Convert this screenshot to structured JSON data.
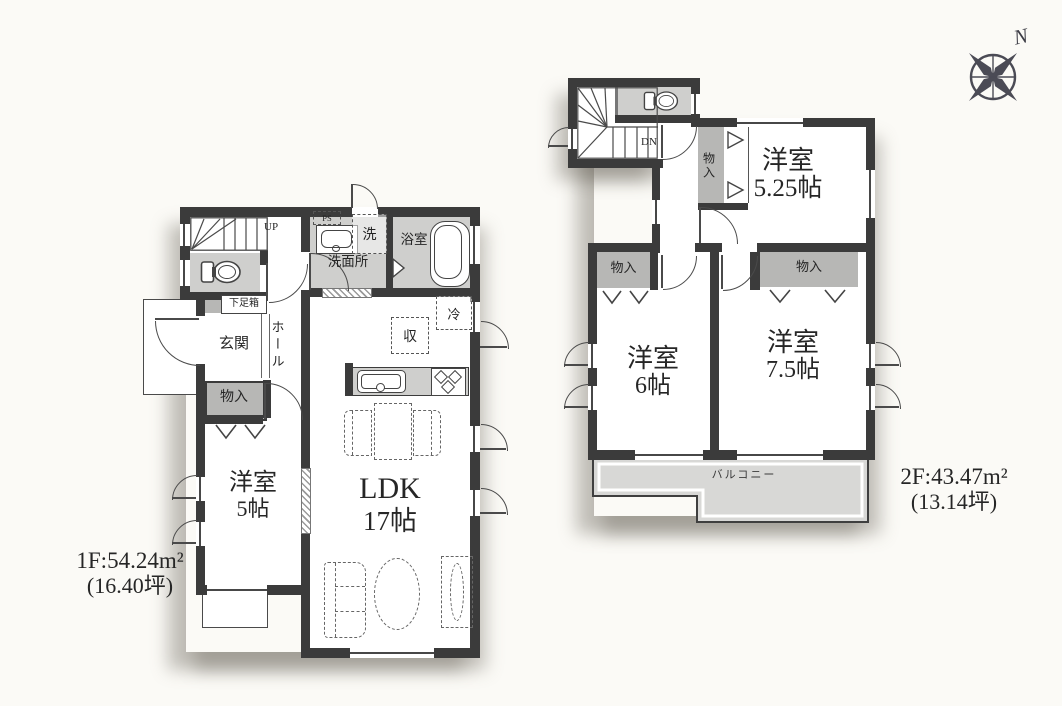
{
  "compass": {
    "north_label": "N"
  },
  "floor1": {
    "area_line1": "1F:54.24m²",
    "area_line2": "(16.40坪)",
    "stairs_label": "UP",
    "rooms": {
      "genkan": "玄関",
      "hall": "ホール",
      "shoebox": "下足箱",
      "storage": "物入",
      "bedroom_name": "洋室",
      "bedroom_size": "5帖",
      "ldk_name": "LDK",
      "ldk_size": "17帖",
      "washroom": "洗面所",
      "bathroom": "浴室",
      "washer": "洗",
      "ps": "PS",
      "fridge": "冷",
      "pantry": "収"
    }
  },
  "floor2": {
    "area_line1": "2F:43.47m²",
    "area_line2": "(13.14坪)",
    "stairs_label": "DN",
    "rooms": {
      "closet_a": "物入",
      "bedroom_a_name": "洋室",
      "bedroom_a_size": "5.25帖",
      "closet_b": "物入",
      "closet_c": "物入",
      "bedroom_b_name": "洋室",
      "bedroom_b_size": "6帖",
      "bedroom_c_name": "洋室",
      "bedroom_c_size": "7.5帖",
      "balcony": "バルコニー"
    }
  }
}
